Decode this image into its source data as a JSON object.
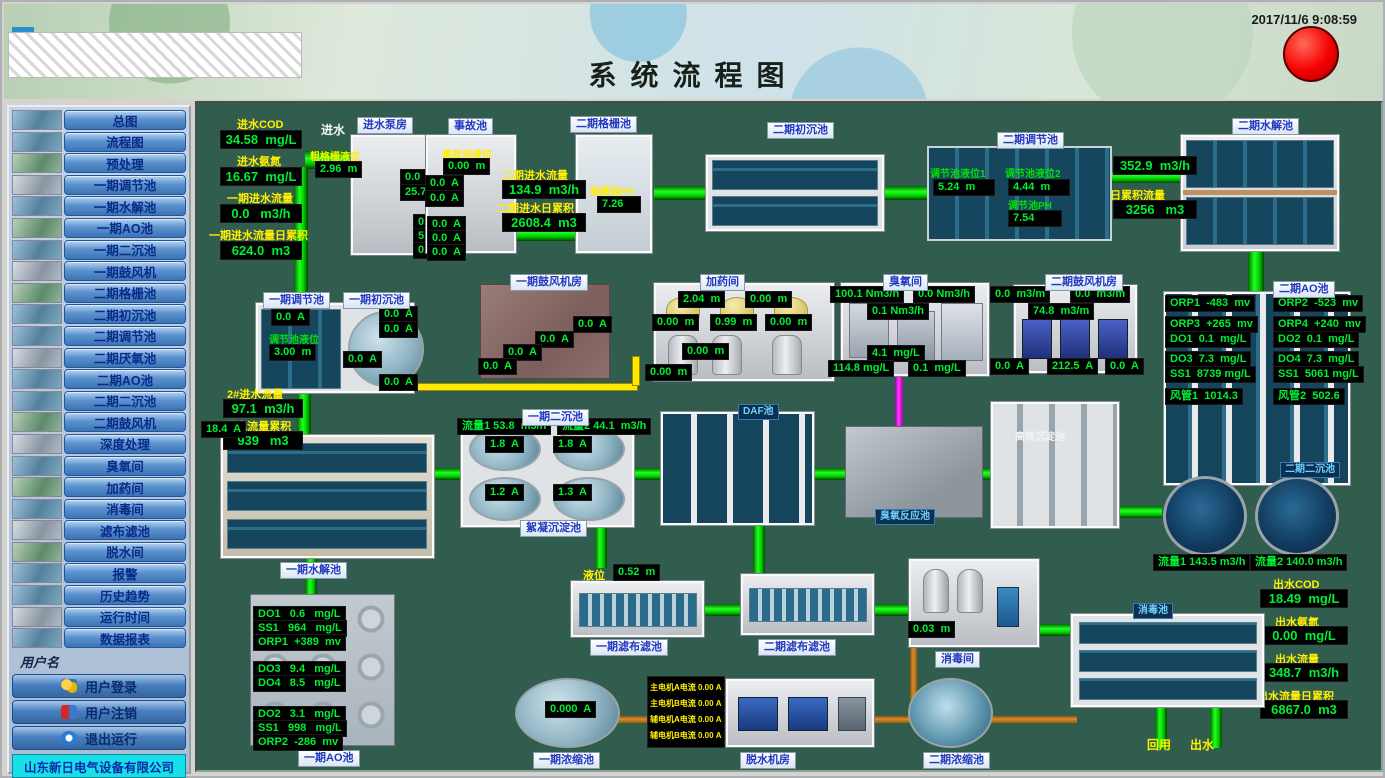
{
  "header": {
    "title": "系统流程图",
    "time": "2017/11/6 9:08:59"
  },
  "sidebar": {
    "nav": [
      "总图",
      "流程图",
      "预处理",
      "一期调节池",
      "一期水解池",
      "一期AO池",
      "一期二沉池",
      "一期鼓风机",
      "二期格栅池",
      "二期初沉池",
      "二期调节池",
      "二期厌氧池",
      "二期AO池",
      "二期二沉池",
      "二期鼓风机",
      "深度处理",
      "臭氧间",
      "加药间",
      "消毒间",
      "滤布滤池",
      "脱水间",
      "报警",
      "历史趋势",
      "运行时间",
      "数据报表"
    ],
    "user_label": "用户名",
    "login": "用户登录",
    "logout": "用户注销",
    "exit": "退出运行",
    "company": "山东新日电气设备有限公司"
  },
  "m": {
    "inlet": {
      "l1": "进水COD",
      "v1": "34.58  mg/L",
      "l2": "进水氨氮",
      "v2": "16.67  mg/L",
      "l3": "一期进水流量",
      "v3": "0.0   m3/h",
      "l4": "一期进水流量日累积",
      "v4": "624.0  m3",
      "water": "进水"
    },
    "pump": {
      "tag": "进水泵房",
      "ll": "粗格栅液位",
      "lv": "2.96  m",
      "i": [
        "0.0  A",
        "25.7  A",
        "0.0  A",
        "5.9  A",
        "0.0  A"
      ]
    },
    "acc": {
      "tag": "事故池",
      "ll": "事故池液位",
      "lv": "0.00  m",
      "i": [
        "0.0  A",
        "0.0  A",
        "0.0  A",
        "0.0  A",
        "0.0  A"
      ]
    },
    "in2": {
      "l1": "二期进水流量",
      "v1": "134.9  m3/h",
      "l2": "二期进水日累积",
      "v2": "2608.4  m3"
    },
    "grille": {
      "tag": "二期格栅池",
      "ll": "格栅池PH",
      "lv": "7.26"
    },
    "sed0": {
      "tag": "二期初沉池"
    },
    "reg2": {
      "tag": "二期调节池",
      "l1": "调节池液位1",
      "v1": "5.24  m",
      "l2": "调节池液位2",
      "v2": "4.44  m",
      "l3": "调节池PH",
      "v3": "7.54"
    },
    "hyd2": {
      "tag": "二期水解池",
      "f": "352.9  m3/h",
      "tl": "日累积流量",
      "t": "3256   m3"
    },
    "reg1": {
      "tag1": "一期调节池",
      "tag2": "一期初沉池",
      "i0": "0.0  A",
      "ll": "调节池液位",
      "lv": "3.00  m",
      "i": [
        "0.0  A",
        "0.0  A",
        "0.0  A",
        "0.0  A"
      ],
      "fl": "2#进水流量",
      "fv": "97.1  m3/h",
      "tl": "2#进水流量累积",
      "tv": "939   m3"
    },
    "blw1": {
      "tag": "一期鼓风机房",
      "i": [
        "0.0  A",
        "0.0  A",
        "0.0  A",
        "0.0  A"
      ]
    },
    "dos": {
      "tag": "加药间",
      "v": [
        "2.04  m",
        "0.00  m",
        "0.00  m",
        "0.99  m",
        "0.00  m",
        "0.00  m",
        "0.00  m"
      ]
    },
    "ozr": {
      "tag": "臭氧间",
      "v": [
        "100.1 Nm3/h",
        "0.0 Nm3/h",
        "0.1 Nm3/h",
        "4.1  mg/L",
        "114.8 mg/L",
        "0.1  mg/L"
      ]
    },
    "blw2": {
      "tag": "二期鼓风机房",
      "v": [
        "0.0  m3/m",
        "0.0  m3/m",
        "74.8  m3/m",
        "0.0  A",
        "212.5  A",
        "0.0  A"
      ]
    },
    "ao2": {
      "tag": "二期AO池",
      "v": [
        "ORP1  -483  mv",
        "ORP2  -523  mv",
        "ORP3  +265  mv",
        "ORP4  +240  mv",
        "DO1  0.1  mg/L",
        "DO2  0.1  mg/L",
        "DO3  7.3  mg/L",
        "DO4  7.3  mg/L",
        "SS1  8739 mg/L",
        "SS1  5061 mg/L",
        "风管1  1014.3",
        "风管2  502.6"
      ]
    },
    "hyd1": {
      "tag": "一期水解池",
      "i": "18.4  A"
    },
    "sed1": {
      "tag": "一期二沉池",
      "f1": "流量1 53.8  m3/h",
      "f2": "流量2 44.1  m3/h",
      "i": [
        "1.8  A",
        "1.8  A",
        "1.2  A",
        "1.3  A"
      ],
      "tag2": "絮凝沉淀池"
    },
    "daf": {
      "tag": "DAF池"
    },
    "ozt": {
      "tag": "臭氧反应池"
    },
    "hes": {
      "tag": "高效沉淀池"
    },
    "sed2": {
      "tag": "二期二沉池",
      "f1": "流量1 143.5 m3/h",
      "f2": "流量2 140.0 m3/h"
    },
    "out": {
      "l1": "出水COD",
      "v1": "18.49  mg/L",
      "l2": "出水氨氮",
      "v2": "0.00  mg/L",
      "l3": "出水流量",
      "v3": "348.7  m3/h",
      "l4": "出水流量日累积",
      "v4": "6867.0  m3"
    },
    "ao1": {
      "tag": "一期AO池",
      "v": [
        "DO1   0.6   mg/L",
        "SS1   964   mg/L",
        "ORP1  +389  mv",
        "DO3   9.4   mg/L",
        "DO4   8.5   mg/L",
        "DO2   3.1   mg/L",
        "SS1   998   mg/L",
        "ORP2  -286  mv"
      ]
    },
    "flt1": {
      "ll": "液位",
      "lv": "0.52  m",
      "tag": "一期滤布滤池"
    },
    "flt2": {
      "tag": "二期滤布滤池"
    },
    "dis": {
      "tag": "消毒间",
      "lv": "0.03  m"
    },
    "disp": {
      "tag": "消毒池"
    },
    "thk1": {
      "tag": "一期浓缩池",
      "i": "0.000  A"
    },
    "dwt": {
      "tag": "脱水机房",
      "rows": [
        "主电机A电流 0.00 A",
        "主电机B电流 0.00 A",
        "辅电机A电流 0.00 A",
        "辅电机B电流 0.00 A"
      ]
    },
    "thk2": {
      "tag": "二期浓缩池"
    },
    "reuse": "回用",
    "outlet": "出水"
  }
}
